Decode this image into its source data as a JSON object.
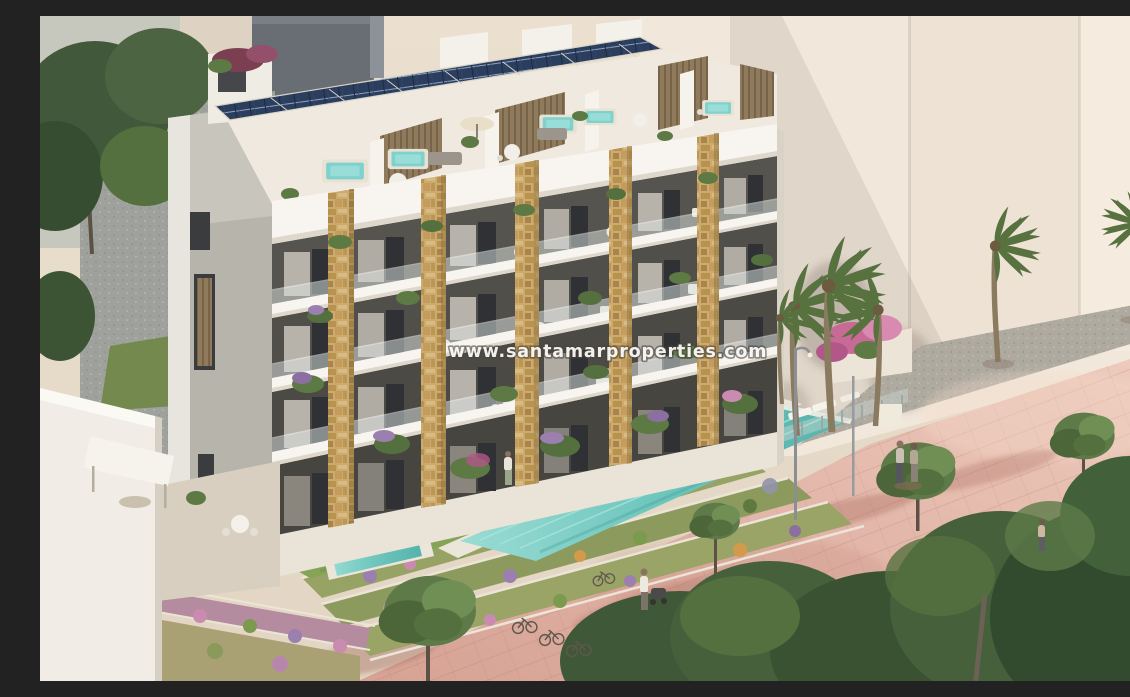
{
  "watermark": {
    "text": "www.santamarproperties.com"
  },
  "scene": {
    "type": "architectural-render",
    "subject": "new-build apartment residence with communal pool beside a seafront promenade",
    "elements": [
      "apartment-building",
      "solar-panel-array",
      "rooftop-terraces",
      "hot-tubs",
      "stone-clad-pillars",
      "balconies-with-plants",
      "garden-level-hedge",
      "lawn",
      "infinity-pool",
      "plunge-pool",
      "swimmer",
      "flower-terraces",
      "pink-promenade",
      "palm-trees",
      "promenade-trees",
      "pedestrians",
      "person-with-stroller",
      "bicycles",
      "street-lamp",
      "sun-loungers",
      "background-buildings",
      "white-boundary-wall"
    ]
  },
  "palette": {
    "sky": "#e8ddcc",
    "building_white": "#f4f0e8",
    "gable_grey": "#b7b4ab",
    "stone_pillar": "#c6a267",
    "solar_panel": "#2c3e5e",
    "pool_water": "#73c9c0",
    "lawn_green": "#84a356",
    "hedge_green": "#4f6c3c",
    "foliage_dark": "#3f5838",
    "promenade_pink": "#e0b4a8",
    "background_wall": "#f1e8db",
    "gravel_grey": "#a5a29a"
  }
}
